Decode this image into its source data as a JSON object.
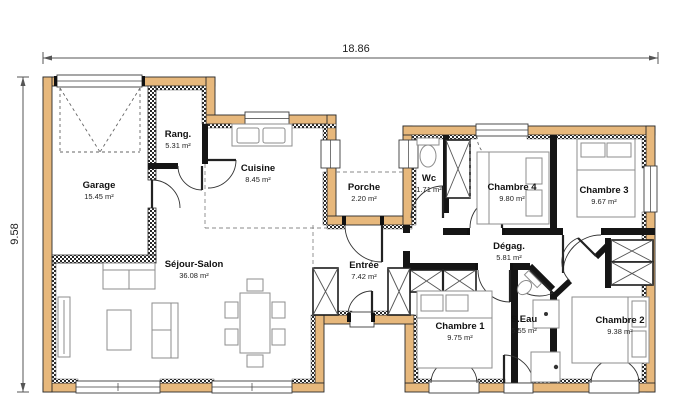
{
  "plan": {
    "width_dimension": "18.86",
    "height_dimension": "9.58"
  },
  "rooms": [
    {
      "id": "garage",
      "name": "Garage",
      "area": "15.45 m²"
    },
    {
      "id": "rang",
      "name": "Rang.",
      "area": "5.31 m²"
    },
    {
      "id": "cuisine",
      "name": "Cuisine",
      "area": "8.45 m²"
    },
    {
      "id": "porche",
      "name": "Porche",
      "area": "2.20 m²"
    },
    {
      "id": "wc",
      "name": "Wc",
      "area": "1.71 m²"
    },
    {
      "id": "chambre4",
      "name": "Chambre 4",
      "area": "9.80 m²"
    },
    {
      "id": "chambre3",
      "name": "Chambre 3",
      "area": "9.67 m²"
    },
    {
      "id": "sejour",
      "name": "Séjour-Salon",
      "area": "36.08 m²"
    },
    {
      "id": "entree",
      "name": "Entrée",
      "area": "7.42 m²"
    },
    {
      "id": "degag",
      "name": "Dégag.",
      "area": "5.81 m²"
    },
    {
      "id": "chambre1",
      "name": "Chambre 1",
      "area": "9.75 m²"
    },
    {
      "id": "seau",
      "name": "S.Eau",
      "area": "5.55 m²"
    },
    {
      "id": "chambre2",
      "name": "Chambre 2",
      "area": "9.38 m²"
    }
  ],
  "colors": {
    "exterior_wall": "#e7b87c",
    "interior_wall": "#151515",
    "background": "#ffffff"
  }
}
